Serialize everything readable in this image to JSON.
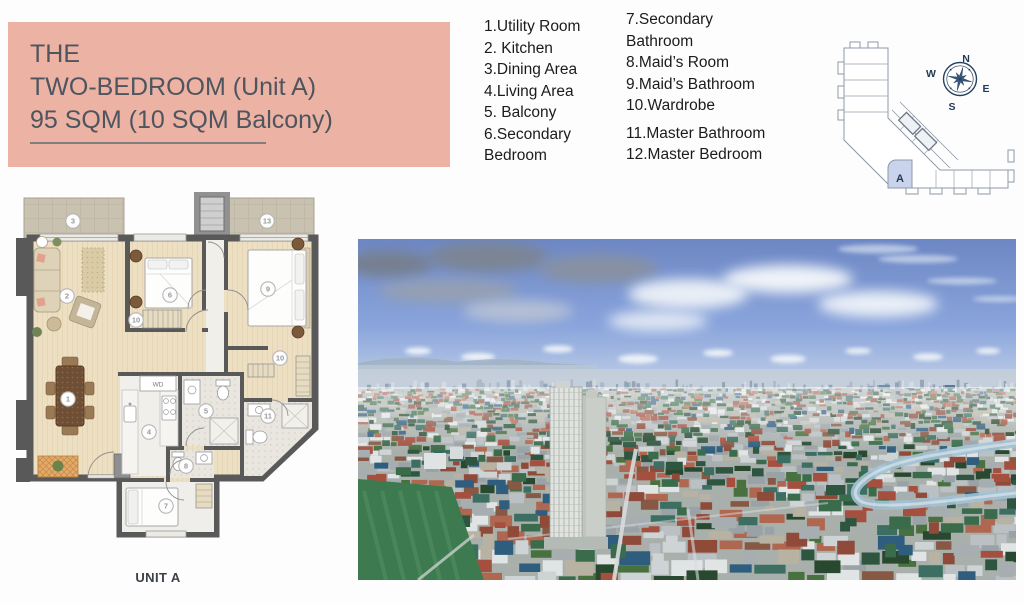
{
  "title_block": {
    "line1": "THE",
    "line2": "TWO-BEDROOM (Unit A)",
    "line3": "95 SQM (10 SQM Balcony)"
  },
  "legend": {
    "col1": [
      "1.Utility Room",
      "2. Kitchen",
      "3.Dining Area",
      "4.Living Area",
      "5. Balcony",
      "6.Secondary\nBedroom"
    ],
    "col2_group1": [
      "7.Secondary\nBathroom",
      "8.Maid’s Room",
      "9.Maid’s Bathroom",
      "10.Wardrobe"
    ],
    "col2_group2": [
      "11.Master Bathroom",
      "12.Master Bedroom"
    ]
  },
  "floorplan": {
    "unit_label": "UNIT A",
    "wd_label": "WD",
    "markers": [
      {
        "room": "balcony-left",
        "label": "3"
      },
      {
        "room": "balcony-right",
        "label": "13"
      },
      {
        "room": "living-area",
        "label": "2"
      },
      {
        "room": "secondary-bedroom",
        "label": "6"
      },
      {
        "room": "master-bedroom",
        "label": "9"
      },
      {
        "room": "wardrobe-secondary",
        "label": "10"
      },
      {
        "room": "wardrobe-master",
        "label": "10"
      },
      {
        "room": "dining-area",
        "label": "1"
      },
      {
        "room": "kitchen",
        "label": "4"
      },
      {
        "room": "secondary-bathroom",
        "label": "5"
      },
      {
        "room": "master-bathroom",
        "label": "11"
      },
      {
        "room": "maids-bathroom",
        "label": "8"
      },
      {
        "room": "maids-room",
        "label": "7"
      }
    ]
  },
  "plate": {
    "unit_letter": "A",
    "compass": {
      "n": "N",
      "e": "E",
      "s": "S",
      "w": "W"
    }
  },
  "photo": {
    "description": "aerial city view with high-rise tower and skyline",
    "palette": {
      "sky_top": "#6d87c4",
      "sky_mid": "#8aa5dc",
      "sky_low": "#c3d1e8",
      "haze": "#e8edf3",
      "cloud_gray_dark": "#767e89",
      "cloud_gray": "#9aa1ab",
      "cloud_white": "#f5f8fb",
      "sea": "#b7c7d5",
      "distant": "#c4cfda",
      "skyline": [
        "#46688f",
        "#35557a",
        "#58789c",
        "#2f4f72",
        "#4f7f6f",
        "#6f8fae",
        "#cfd8df",
        "#3e6287"
      ],
      "glass_green": "#3f8f7c",
      "river": "#a3c2d4",
      "field": "#3e7a50",
      "field_light": "#4c8a5c",
      "tower_face": "#e0e3df",
      "tower_side": "#c9cec9",
      "walls": [
        "#ced3d5",
        "#bac0c3",
        "#a6aeb1",
        "#e1e4e5",
        "#98a2a7"
      ],
      "roofs": [
        "#a5503f",
        "#b06750",
        "#8f4a3a",
        "#2f5d7e",
        "#3d6e62",
        "#49703f",
        "#b8b2a2",
        "#875843"
      ],
      "trees": [
        "#2e5540",
        "#3a6b4a",
        "#28492f"
      ],
      "road": "#d8dcdd"
    }
  },
  "colors": {
    "title_bg": "#ecb2a3",
    "title_text": "#4e555e",
    "legend_text": "#1b1b1b",
    "wall": "#595959",
    "wood_floor": "#eddfc2",
    "balcony_floor": "#c9c2b0",
    "tile_floor": "#e9e6df",
    "unit_highlight": "#c9d3ec",
    "compass_navy": "#27425e",
    "plate_line": "#8e99a6"
  }
}
